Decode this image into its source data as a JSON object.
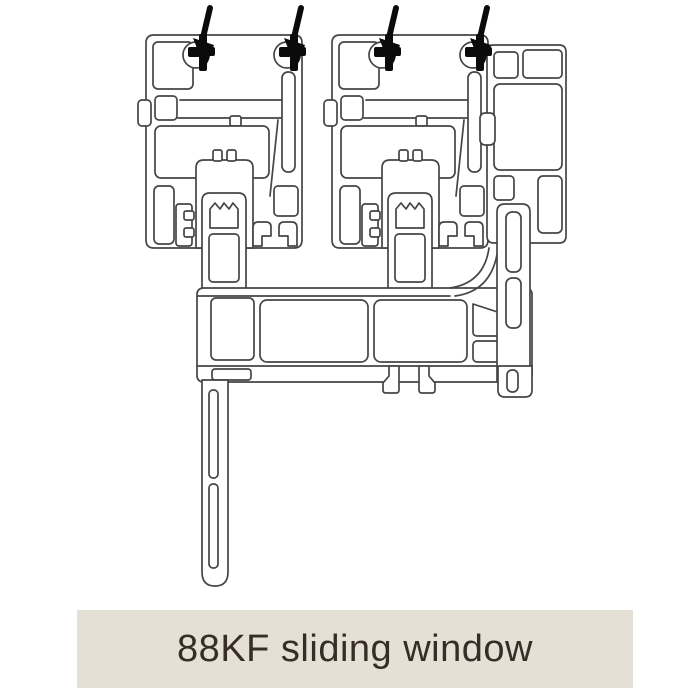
{
  "caption": {
    "text": "88KF sliding window",
    "background_color": "#e5e0d6",
    "text_color": "#362e26"
  },
  "diagram": {
    "kind": "window-profile-cross-section",
    "background_color": "#ffffff",
    "line_color": "#454545",
    "seal_color": "#0b0b0b",
    "arrow_count": 4,
    "parts": [
      "left-sash-profile",
      "right-sash-profile",
      "side-jamb-frame-profile",
      "bottom-track-frame-profile",
      "drop-leg-fin",
      "brush-seal",
      "seal-insertion-arrow"
    ]
  }
}
